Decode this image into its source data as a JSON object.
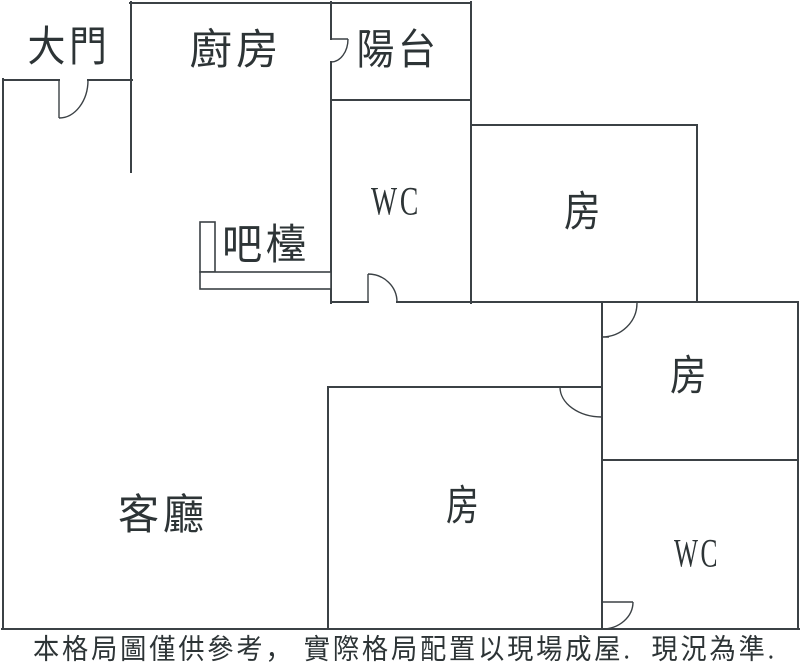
{
  "colors": {
    "background": "#ffffff",
    "wall": "#3b4145",
    "text": "#2d3436"
  },
  "labels": {
    "entrance": "大門",
    "kitchen": "廚房",
    "balcony": "陽台",
    "wc_upper": "WC",
    "bedroom_upper_right": "房",
    "bar_counter": "吧檯",
    "bedroom_middle_right": "房",
    "living_room": "客廳",
    "bedroom_bottom_middle": "房",
    "wc_lower": "WC"
  },
  "caption": "本格局圖僅供參考， 實際格局配置以現場成屋.  現況為準."
}
